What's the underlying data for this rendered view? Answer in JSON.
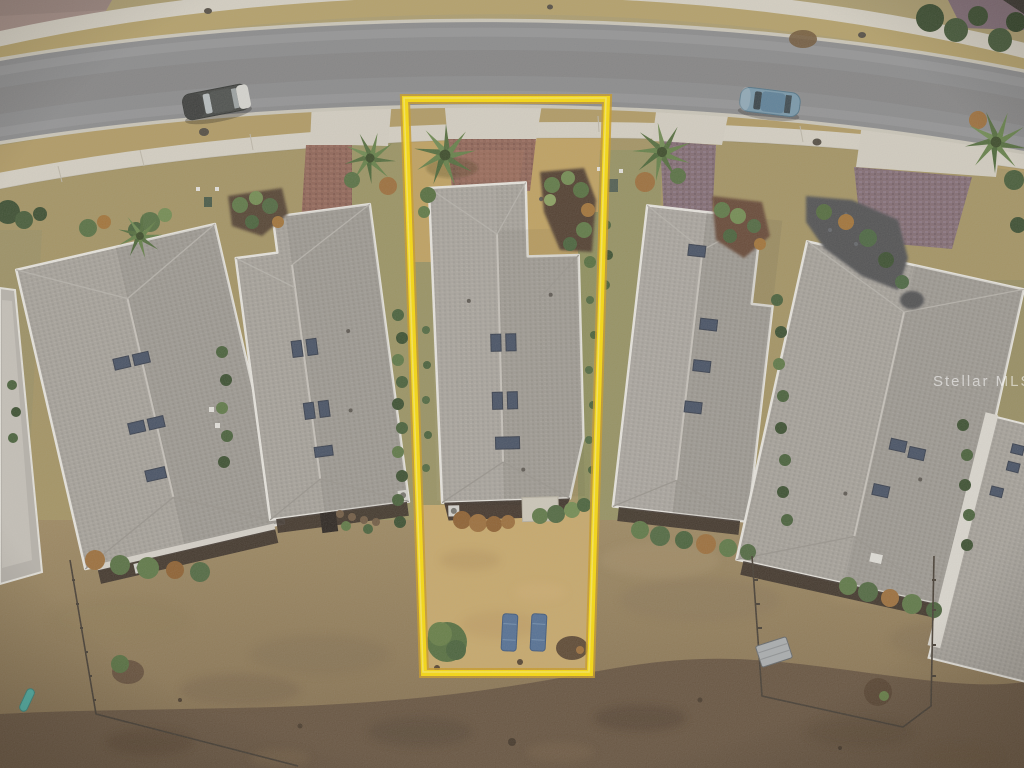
{
  "image": {
    "kind": "aerial drone photograph",
    "scene": "row of single-story shingle-roof homes along a curved street; center lot highlighted with yellow boundary"
  },
  "watermark": {
    "text": "Stellar MLS"
  },
  "lot_outline": {
    "color": "#FFDF00",
    "corners_px": [
      [
        405,
        99
      ],
      [
        607,
        99
      ],
      [
        590,
        673
      ],
      [
        424,
        673
      ]
    ]
  },
  "objects": {
    "houses_visible": 7,
    "cars": [
      {
        "name": "suv-parked-left",
        "body_color": "#3A3E3D"
      },
      {
        "name": "sedan-parked-right",
        "body_color": "#7397AD"
      }
    ],
    "backyard_loungers": 2,
    "palm_trees": 5,
    "fenced_yards": 2
  },
  "palette": {
    "asphalt": "#87898C",
    "concrete_sidewalk": "#D8D4C8",
    "dormant_grass": "#B09A60",
    "roof_shingle": "#A5A29C",
    "paver_driveway": "#8C5F52",
    "backyard_turf": "#C9A968",
    "bare_field": "#5F4C38",
    "skylight": "#3C4960",
    "hedge_green": "#3E5A32"
  }
}
